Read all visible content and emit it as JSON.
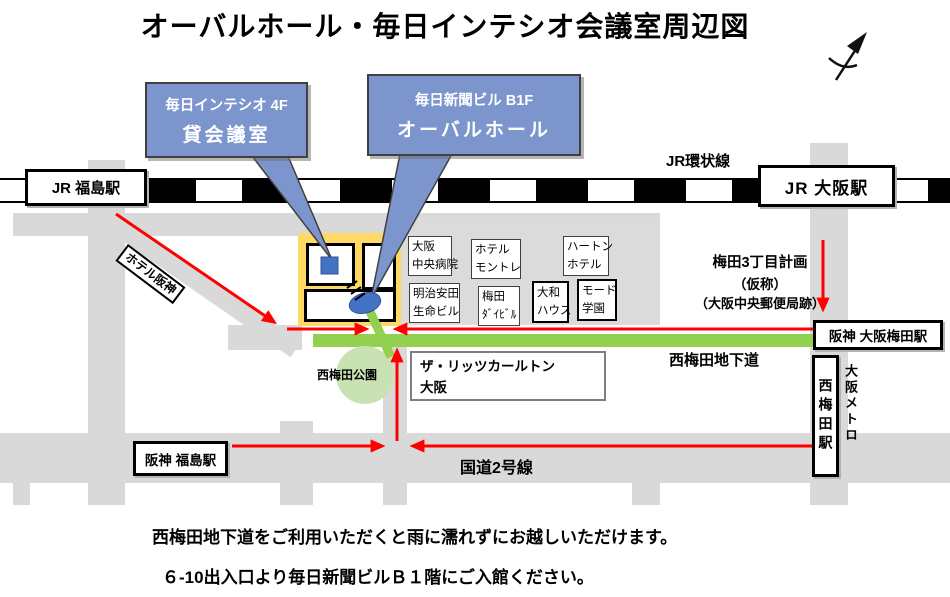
{
  "title": "オーバルホール・毎日インテシオ会議室周辺図",
  "callouts": {
    "intesio": {
      "line1": "毎日インテシオ 4F",
      "line2": "貸会議室"
    },
    "oval_hall": {
      "line1": "毎日新聞ビル B1F",
      "line2": "オーバルホール"
    }
  },
  "stations": {
    "jr_fukushima": "JR 福島駅",
    "jr_osaka": "JR 大阪駅",
    "hanshin_osaka_umeda": "阪神 大阪梅田駅",
    "nishi_umeda": "西梅田駅",
    "hanshin_fukushima": "阪神 福島駅"
  },
  "labels": {
    "jr_loop_line": "JR環状線",
    "underground_passage": "西梅田地下道",
    "route_2": "国道2号線",
    "park": "西梅田公園",
    "osaka_metro": "大阪メトロ",
    "hotel_hanshin": "ホテル阪神",
    "umeda_3_plan": "梅田3丁目計画",
    "umeda_3_plan_sub1": "（仮称）",
    "umeda_3_plan_sub2": "（大阪中央郵便局跡）"
  },
  "buildings": {
    "osaka_chuo_hospital": [
      "大阪",
      "中央病院"
    ],
    "hotel_monterey": [
      "ホテル",
      "モントレ"
    ],
    "hearton_hotel": [
      "ハートン",
      "ホテル"
    ],
    "meiji_yasuda_seimei": [
      "明治安田",
      "生命ビル"
    ],
    "umeda_daibiru": [
      "梅田",
      "ﾀﾞｲﾋﾞﾙ"
    ],
    "daiwa_house": [
      "大和",
      "ハウス"
    ],
    "mode_gakuen": [
      "モード",
      "学園"
    ],
    "ritz_carlton": [
      "ザ・リッツカールトン",
      "大阪"
    ]
  },
  "notes": {
    "line1": "西梅田地下道をご利用いただくと雨に濡れずにお越しいただけます。",
    "line2": "６-10出入口より毎日新聞ビルＢ１階にご入館ください。"
  },
  "icons": {
    "north_arrow": "north-compass-arrow",
    "stairs": "stairs-icon",
    "intesio_marker": "blue-square-marker",
    "oval_hall_marker": "blue-oval-marker"
  },
  "colors": {
    "route_red": "#FF0000",
    "passage_green": "#92D050",
    "park_green": "#C9E2B3",
    "block_yellow": "#FFD966",
    "callout_blue": "#7C95CC",
    "marker_blue": "#4472C4",
    "road_gray": "#D9D9D9",
    "railway_black": "#000000"
  }
}
